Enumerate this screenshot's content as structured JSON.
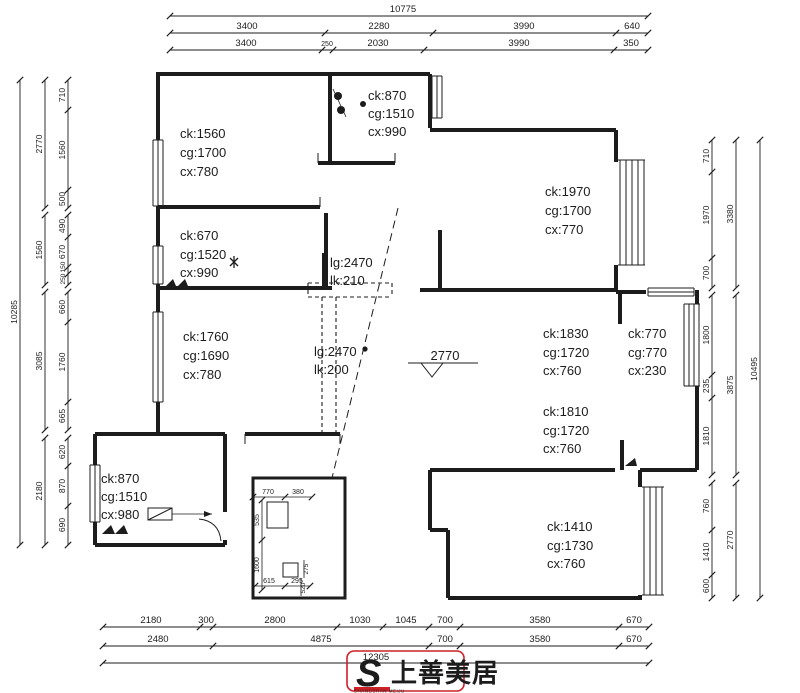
{
  "dims": {
    "top": {
      "total": "10775",
      "row2": [
        "3400",
        "2280",
        "3990",
        "640"
      ],
      "row3": [
        "3400",
        "250",
        "2030",
        "3990",
        "350"
      ]
    },
    "bottom": {
      "row1": [
        "2180",
        "300",
        "2800",
        "1030",
        "1045",
        "700",
        "3580",
        "670"
      ],
      "row2": [
        "2480",
        "4875",
        "700",
        "3580",
        "670"
      ],
      "total": "12305"
    },
    "left": {
      "total": "10285",
      "mid": [
        "2770",
        "1560",
        "3085",
        "2180"
      ],
      "inner": [
        "710",
        "1560",
        "500",
        "490",
        "670",
        "150",
        "250",
        "660",
        "1760",
        "665",
        "620",
        "870",
        "690"
      ]
    },
    "right": {
      "total": "10495",
      "mid": [
        "3380",
        "3875",
        "2770"
      ],
      "inner": [
        "710",
        "1970",
        "700",
        "1800",
        "235",
        "1810",
        "760",
        "1410",
        "600"
      ]
    }
  },
  "rooms": {
    "top_left": [
      "ck:1560",
      "cg:1700",
      "cx:780"
    ],
    "top_center": [
      "ck:870",
      "cg:1510",
      "cx:990"
    ],
    "mid_left": [
      "ck:670",
      "cg:1520",
      "cx:990"
    ],
    "top_right": [
      "ck:1970",
      "cg:1700",
      "cx:770"
    ],
    "left_lower": [
      "ck:1760",
      "cg:1690",
      "cx:780"
    ],
    "right_mid_a": [
      "ck:1830",
      "cg:1720",
      "cx:760"
    ],
    "right_mid_b": [
      "ck:770",
      "cg:770",
      "cx:230"
    ],
    "right_lower": [
      "ck:1810",
      "cg:1720",
      "cx:760"
    ],
    "bottom_left": [
      "ck:870",
      "cg:1510",
      "cx:980"
    ],
    "bottom_right": [
      "ck:1410",
      "cg:1730",
      "cx:760"
    ]
  },
  "beams": {
    "upper": [
      "lg:2470",
      "lk:210"
    ],
    "lower": [
      "lg:2470",
      "lk:200"
    ]
  },
  "elevation": "2770",
  "detail_box": {
    "top": [
      "770",
      "380"
    ],
    "left": [
      "535",
      "1600"
    ],
    "bottom": [
      "615",
      "295"
    ],
    "right": [
      "275",
      "520"
    ]
  },
  "logo": {
    "monogram": "S",
    "name": "上善美居",
    "latin": "SHANGSHAN MEIJU",
    "color": "#cc2127"
  },
  "colors": {
    "line": "#1c1c1c",
    "text": "#1c1c1c",
    "logo_red": "#cc2127"
  }
}
